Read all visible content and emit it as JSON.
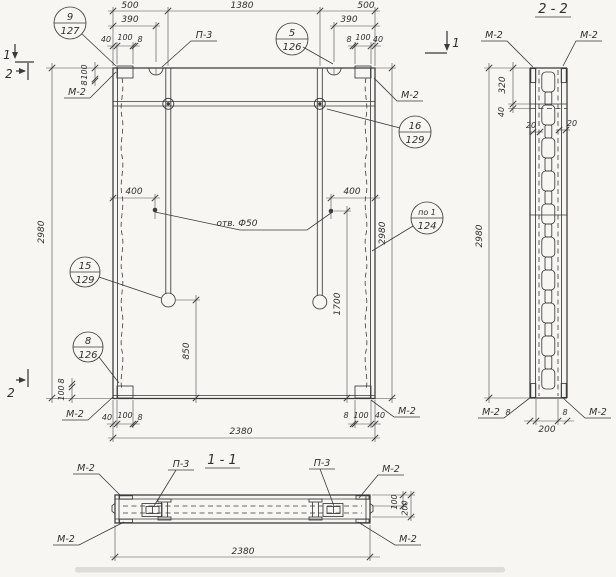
{
  "drawing": {
    "labels": {
      "m2": "М-2",
      "p3": "П-3",
      "hole_note": "отв. Ф50"
    },
    "section_marks": {
      "cut1": "1",
      "cut2": "2"
    },
    "view_titles": {
      "section22": "2 - 2",
      "section11": "1 - 1"
    },
    "dims": {
      "d8": "8",
      "d20": "20",
      "d40": "40",
      "d100": "100",
      "d200": "200",
      "d320": "320",
      "d390": "390",
      "d400": "400",
      "d500": "500",
      "d850": "850",
      "d1380": "1380",
      "d1700": "1700",
      "d2380": "2380",
      "d2980": "2980"
    },
    "callouts": {
      "c9_127": {
        "num": "9",
        "sheet": "127"
      },
      "c5_126": {
        "num": "5",
        "sheet": "126"
      },
      "c16_129": {
        "num": "16",
        "sheet": "129"
      },
      "cpo1_124": {
        "num": "по 1",
        "sheet": "124"
      },
      "c15_129": {
        "num": "15",
        "sheet": "129"
      },
      "c8_126": {
        "num": "8",
        "sheet": "126"
      }
    }
  }
}
